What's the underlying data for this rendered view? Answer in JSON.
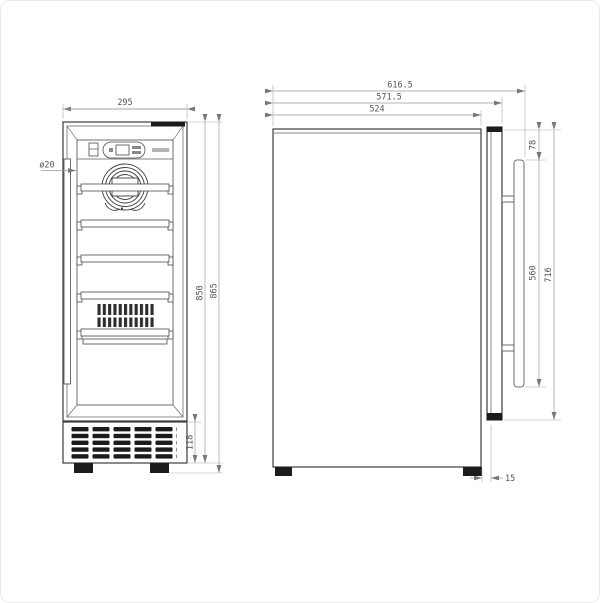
{
  "drawing_title": "beverage-cooler-dimension-drawing",
  "front_view": {
    "name": "front-view",
    "dims": {
      "width": "295",
      "hole_diameter": "ø20",
      "body_height": "850",
      "total_height": "865",
      "vent_height": "118"
    }
  },
  "side_view": {
    "name": "side-view",
    "dims": {
      "depth_total": "616.5",
      "depth_with_door": "571.5",
      "depth_cabinet": "524",
      "handle_top_offset": "78",
      "handle_height": "560",
      "door_height": "716",
      "bottom_gap": "15"
    }
  }
}
